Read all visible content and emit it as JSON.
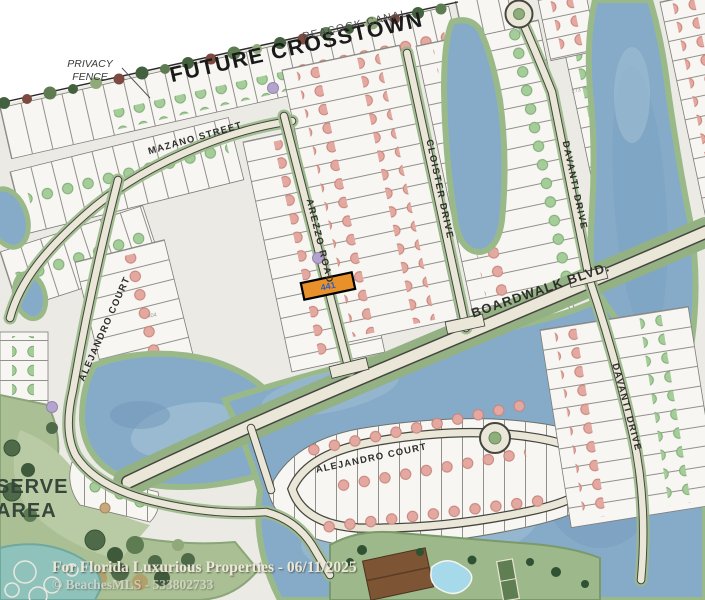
{
  "map": {
    "corridor_label": "FUTURE CROSSTOWN",
    "canal_label": "PEACOCK CANAL",
    "privacy_fence": {
      "line1": "PRIVACY",
      "line2": "FENCE"
    },
    "streets": {
      "mazano": "MAZANO STREET",
      "arezzo": "AREZZO ROAD",
      "cloister": "CLOISTER DRIVE",
      "davanti_top": "DAVANTI DRIVE",
      "davanti_bottom": "DAVANTI DRIVE",
      "boardwalk": "BOARDWALK BLVD.",
      "alejandro_left": "ALEJANDRO COURT",
      "alejandro_bottom": "ALEJANDRO COURT"
    },
    "preserve": {
      "line1": "SERVE",
      "line2": "AREA"
    },
    "highlight_lot": {
      "number": "441",
      "fill": "#e8912b",
      "border": "#000000",
      "text_color": "#2e5fc0"
    },
    "lot_annotations": {
      "n273": "273",
      "n404": "404"
    },
    "colors": {
      "lake": "#86abc9",
      "lake_light": "#a3c1d6",
      "street_fill": "#eae7d8",
      "street_casing": "#46463f",
      "verge_green": "#94b183",
      "preserve_green": "#aabf94",
      "lot_fill": "#f7f6f2",
      "dot_pink": "#e3a89f",
      "dot_green": "#a4cd99",
      "dot_purple": "#b3a4cd"
    }
  },
  "watermark": {
    "line1": "For Florida Luxurious Properties - 06/11/2025",
    "line2": "© BeachesMLS - 533802733"
  }
}
